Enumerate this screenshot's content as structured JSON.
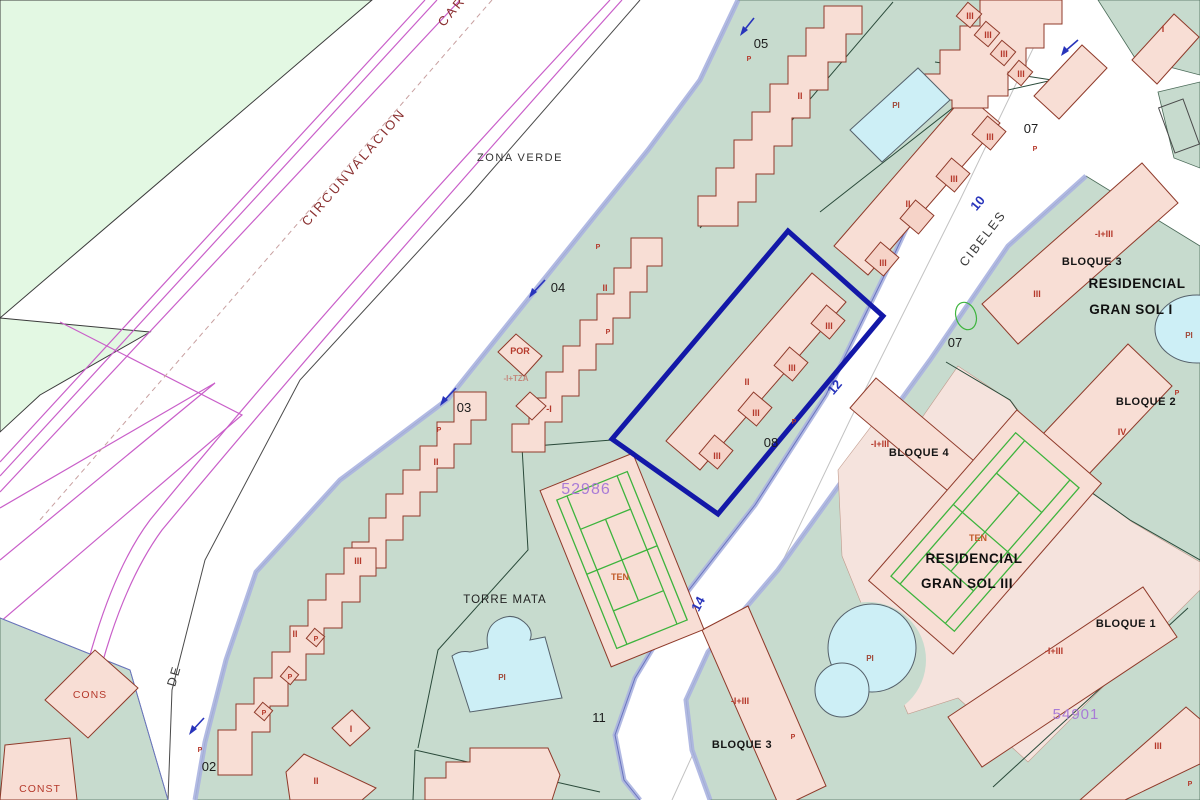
{
  "streets": {
    "circunvalacion": "CIRCUNVALACION",
    "car_partial": "CAR",
    "de": "DE",
    "cibeles": "CIBELES"
  },
  "street_numbers": {
    "n10": "10",
    "n12": "12",
    "n14": "14"
  },
  "zones": {
    "zona_verde": "ZONA VERDE",
    "torre_mata": "TORRE MATA",
    "residencial": "RESIDENCIAL",
    "gran_sol_1": "GRAN SOL I",
    "gran_sol_3": "GRAN SOL III"
  },
  "bloques": {
    "b1": "BLOQUE 1",
    "b2": "BLOQUE 2",
    "b3": "BLOQUE 3",
    "b4": "BLOQUE 4"
  },
  "parcel_numbers": {
    "p02": "02",
    "p03": "03",
    "p04": "04",
    "p05": "05",
    "p07": "07",
    "p08": "08",
    "p11": "11"
  },
  "parcel_codes": {
    "c52986": "52986",
    "c54901": "54901"
  },
  "construction": {
    "cons": "CONS",
    "const": "CONST"
  },
  "floor_labels": {
    "f1": "I",
    "f2": "II",
    "f3": "III",
    "f4": "IV",
    "p": "P",
    "pi": "PI",
    "ten": "TEN",
    "por": "POR",
    "minus1": "-I",
    "minus1_tza": "-I+TZA",
    "minus1_plus3": "-I+III"
  },
  "colors": {
    "building_fill": "#f8ded5",
    "building_outline": "#8f3a2a",
    "parcel_green": "#c7dbce",
    "pale_green": "#e3f8e3",
    "plaza_pink": "#f5e3dd",
    "pool_fill": "#cdeff6",
    "selected_parcel_outline": "#1318a8",
    "road_magenta": "#c95fc9",
    "court_green": "#3db43d",
    "label_red": "#b5392b",
    "label_magenta": "#a97bd6",
    "label_blue": "#2834bb",
    "road_edge_lavender": "#aab2e0"
  }
}
